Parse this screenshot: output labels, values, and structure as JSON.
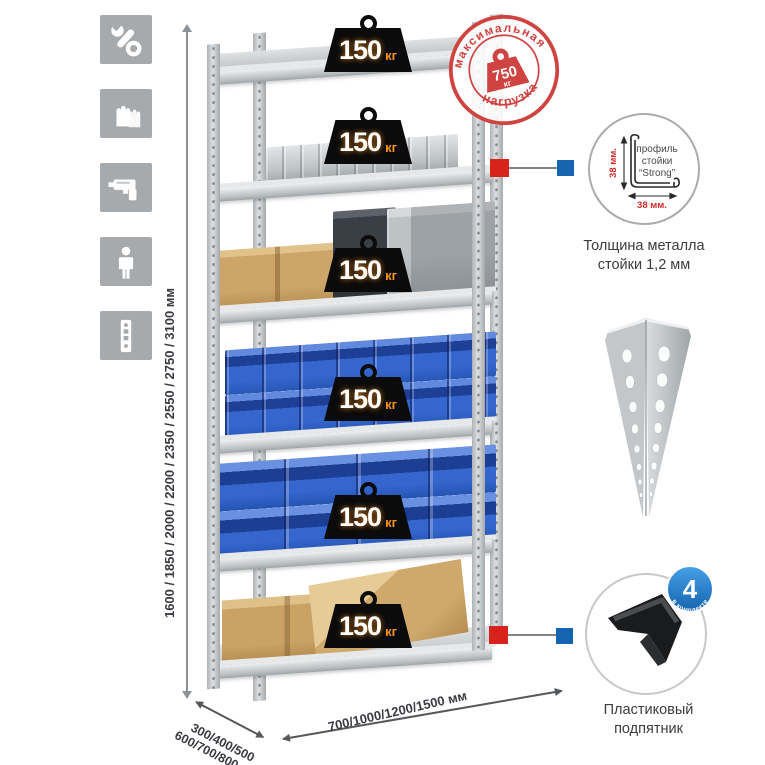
{
  "sidebar": {
    "icons": [
      {
        "name": "wrench-icon"
      },
      {
        "name": "gloves-icon"
      },
      {
        "name": "drill-icon"
      },
      {
        "name": "person-icon"
      },
      {
        "name": "rack-post-icon"
      }
    ]
  },
  "dimensions": {
    "height_label": "1600 / 1850 / 2000 / 2200 / 2350 / 2550 / 2750 / 3100 мм",
    "depth_line1": "300/400/500",
    "depth_line2": "600/700/800 мм",
    "width_label": "700/1000/1200/1500 мм"
  },
  "rack": {
    "shelves": [
      {
        "load": "150",
        "unit": "кг"
      },
      {
        "load": "150",
        "unit": "кг"
      },
      {
        "load": "150",
        "unit": "кг"
      },
      {
        "load": "150",
        "unit": "кг"
      },
      {
        "load": "150",
        "unit": "кг"
      },
      {
        "load": "150",
        "unit": "кг"
      }
    ]
  },
  "max_load_stamp": {
    "arc_top": "максимальная",
    "arc_bottom": "нагрузка",
    "value": "750",
    "unit": "кг"
  },
  "profile_detail": {
    "label_line1": "профиль",
    "label_line2": "стойки",
    "label_line3": "“Strong”",
    "dim_vertical": "38 мм.",
    "dim_horizontal": "38 мм.",
    "caption_line1": "Толщина металла",
    "caption_line2": "стойки 1,2 мм"
  },
  "foot_detail": {
    "badge_value": "4",
    "badge_label": "в комплекте",
    "caption_line1": "Пластиковый",
    "caption_line2": "подпятник"
  },
  "colors": {
    "accent_red": "#d8231d",
    "accent_blue": "#1565b0",
    "stamp_red": "#cf4440",
    "kg_orange": "#f7941d",
    "bin_blue": "#2d5fc0",
    "metal_gray": "#c9cdd0",
    "icon_gray": "#a6aaac"
  }
}
